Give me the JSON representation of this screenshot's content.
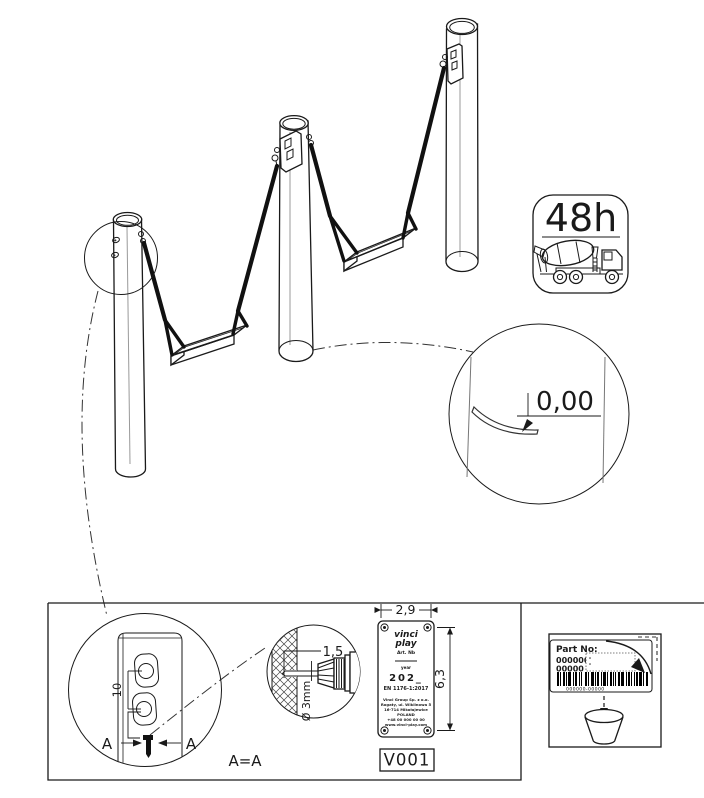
{
  "badge_48h": {
    "label": "48h"
  },
  "level_detail": {
    "value": "0,00"
  },
  "post_hole_detail": {
    "spacing_dim": "10",
    "section_left": "A",
    "section_right": "A",
    "section_equation": "A=A"
  },
  "drill_detail": {
    "depth_dim": "1,5",
    "diameter_dim": "Ø 3mm"
  },
  "label_plate": {
    "width_dim": "2,9",
    "height_dim": "6,3",
    "logo_top": "vinci",
    "logo_bottom": "play",
    "art_no_label": "Art. Nb",
    "year_label": "year",
    "year_value": "202_",
    "standard": "EN 1176-1:2017",
    "address": [
      "Vinci Group Sp. z o.o.",
      "Rogaty, ul. Wiklinowa 5",
      "16-714 Mikołajewice",
      "POLAND",
      "+48 00 000 00 00",
      "www.vinci-play.com"
    ],
    "version": "V001"
  },
  "sticker_box": {
    "title": "Part No:",
    "number_line1": "000000-",
    "number_line2": "00000",
    "barcode_caption": "000000-00000",
    "title_color": "#8b1515",
    "number_color": "#26269b"
  }
}
